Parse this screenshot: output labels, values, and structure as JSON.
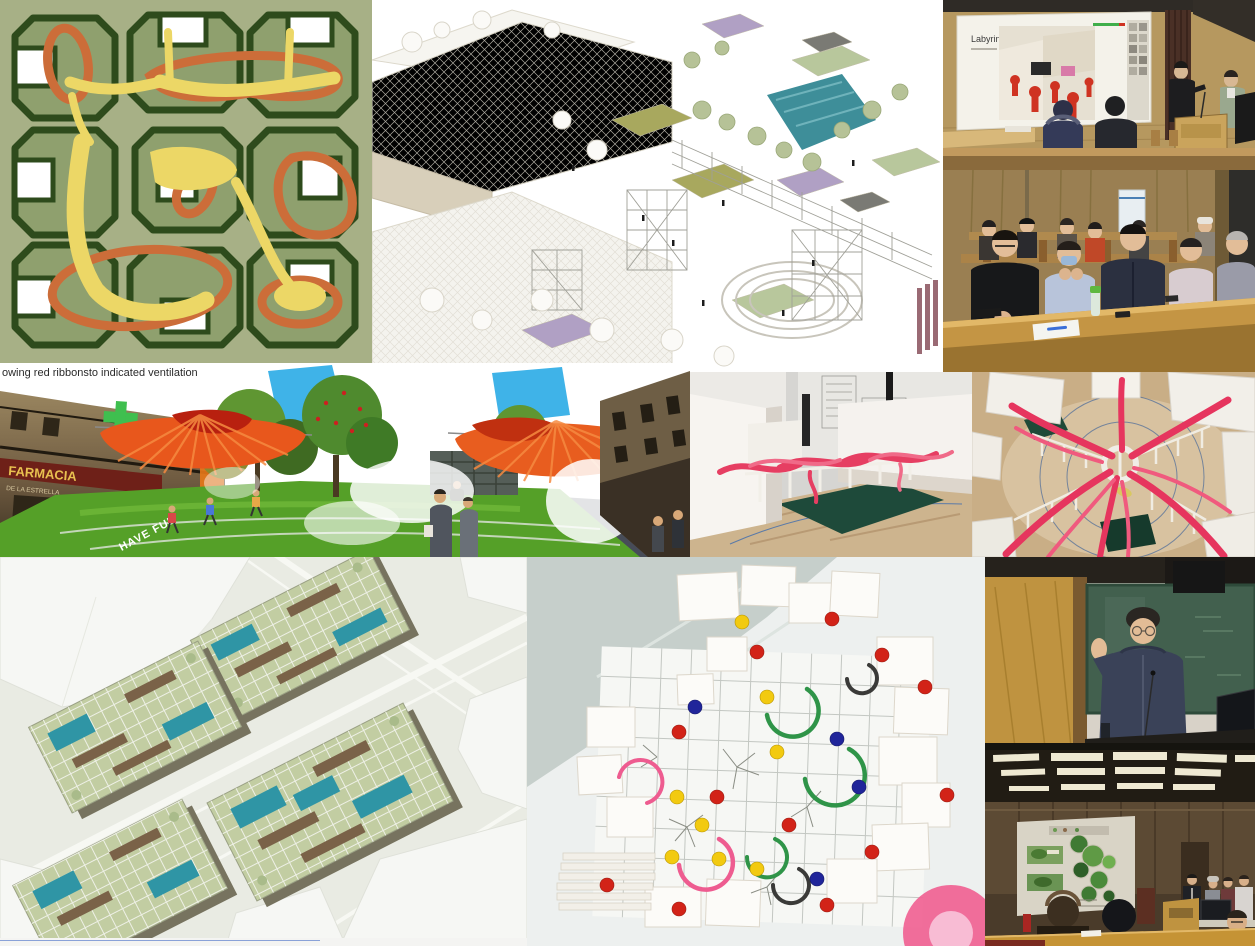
{
  "texts": {
    "caption": "owing red ribbonsto indicated ventilation",
    "slide_title": "Labyrinth",
    "pharmacy_sign": "FARMACIA",
    "pharmacy_subtitle": "DE LA ESTRELLA",
    "lawn_text": "HAVE FUN"
  },
  "palette": {
    "plan_background": "#a7b086",
    "plan_building_dark": "#2e4b1c",
    "plan_building_sage": "#8fa06e",
    "plan_path_yellow": "#ecd766",
    "plan_ribbon_orange": "#cc6d39",
    "canopy_orange": "#e8571c",
    "ribbon_pink": "#e6355e",
    "pool_teal": "#2f95a5",
    "chalkboard_green": "#42604e",
    "wood_wall": "#b6985f",
    "desk_yellow": "#c59335",
    "pin_red": "#d22318",
    "pin_yellow": "#f2ca10",
    "pin_blue": "#20259a",
    "spiral_green": "#2f9448",
    "lawn_green": "#55a028",
    "pharmacy_cross_green": "#3fbf4f"
  }
}
